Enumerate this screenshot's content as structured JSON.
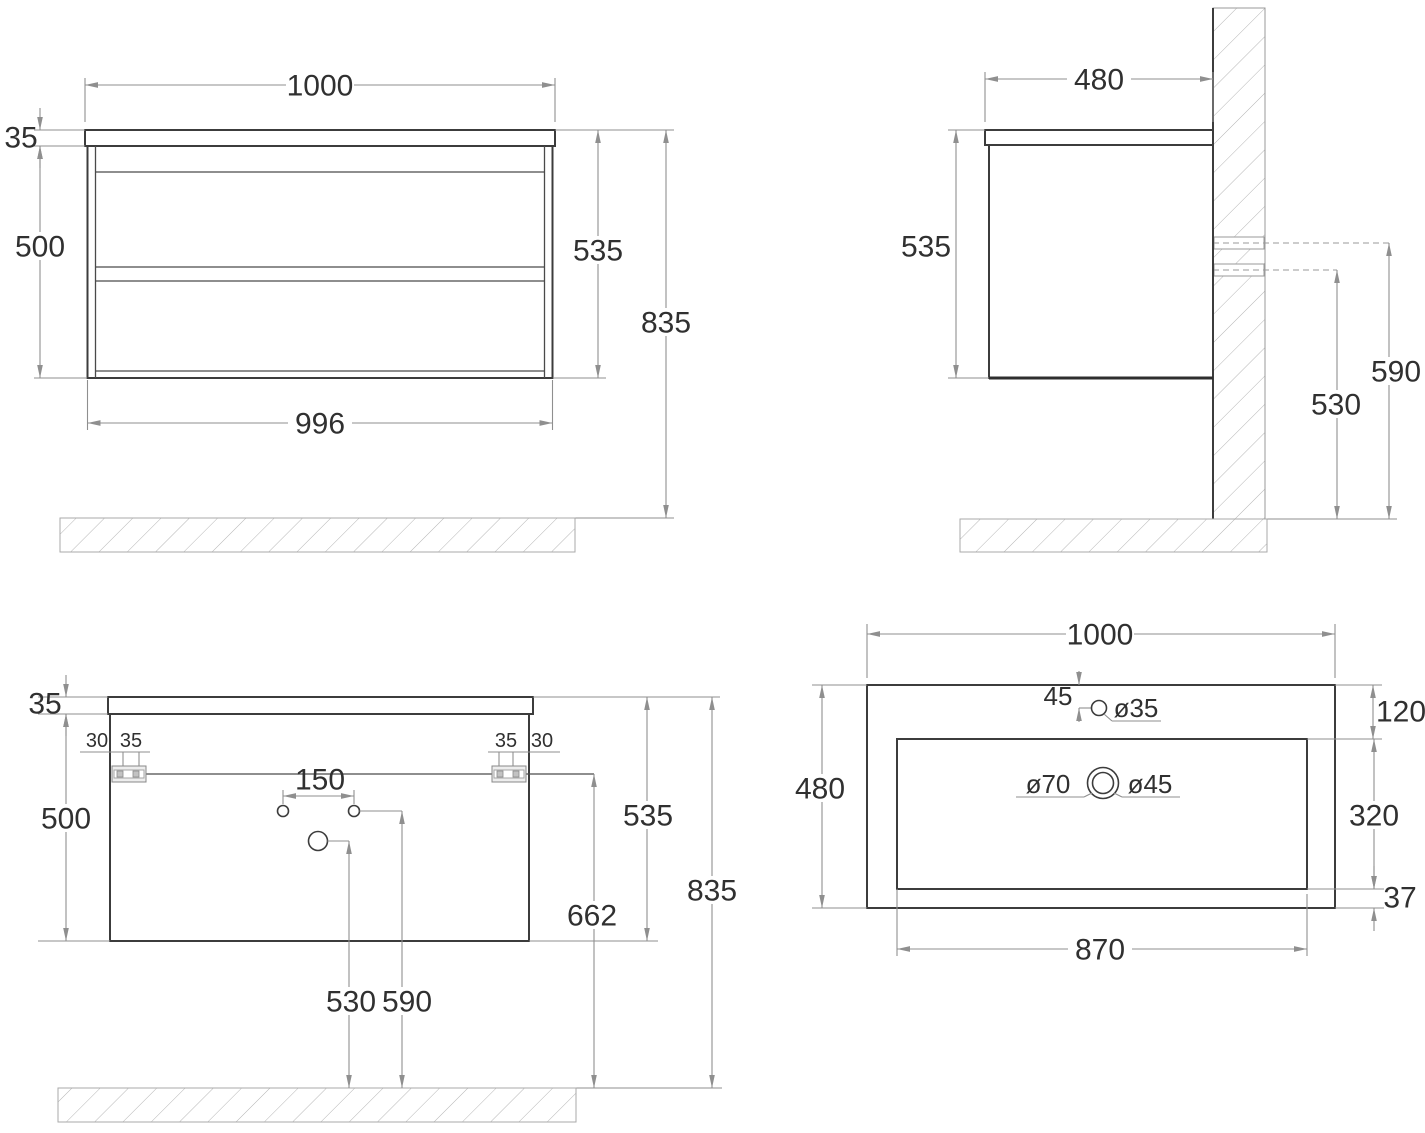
{
  "drawing_title": "vanity-cabinet-technical-drawing",
  "colors": {
    "object_line": "#3c3c3c",
    "dimension_line": "#8f8f8f",
    "text": "#303030",
    "background": "#ffffff"
  },
  "front": {
    "width": "1000",
    "top_thickness": "35",
    "body_height": "500",
    "height": "535",
    "total_height": "835",
    "body_width": "996"
  },
  "side": {
    "depth": "480",
    "height": "535",
    "upper_fixing_height": "590",
    "lower_fixing_height": "530"
  },
  "back": {
    "top_thickness": "35",
    "body_height": "500",
    "left_offset_30": "30",
    "left_offset_35": "35",
    "right_offset_35": "35",
    "right_offset_30": "30",
    "tap_hole_spacing": "150",
    "drain_height": "530",
    "supply_height": "590",
    "bracket_height": "662",
    "height": "535",
    "total_height": "835"
  },
  "top": {
    "width": "1000",
    "depth": "480",
    "tap_offset": "45",
    "tap_hole": "ø35",
    "overflow_hole": "ø70",
    "drain_hole": "ø45",
    "rim_top": "120",
    "basin_depth": "320",
    "rim_bottom": "37",
    "basin_width": "870"
  }
}
